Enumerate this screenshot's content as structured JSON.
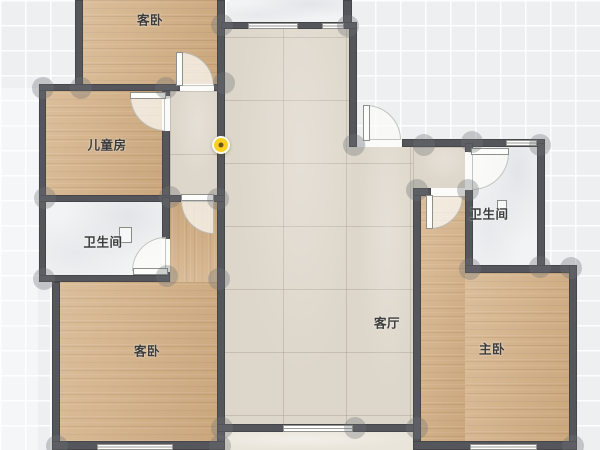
{
  "app": {
    "view": "floorplan-editor-2d"
  },
  "rooms": [
    {
      "name": "guest-bedroom-top",
      "label": "客卧"
    },
    {
      "name": "kids-room",
      "label": "儿童房"
    },
    {
      "name": "bathroom-left",
      "label": "卫生间"
    },
    {
      "name": "guest-bedroom-bottom",
      "label": "客卧"
    },
    {
      "name": "living-room",
      "label": "客厅"
    },
    {
      "name": "bathroom-right",
      "label": "卫生间"
    },
    {
      "name": "master-bedroom",
      "label": "主卧"
    }
  ],
  "markers": {
    "camera_viewpoint": {
      "icon": "camera-viewpoint-dot",
      "color": "#ffd020"
    }
  },
  "colors": {
    "background": "#edeff1",
    "wall": "#55565c",
    "wood_floor": "#d1ae84",
    "tile_floor": "#ddd6ca",
    "marble_floor": "#f2f3f4",
    "camera_dot": "#ffd020"
  }
}
